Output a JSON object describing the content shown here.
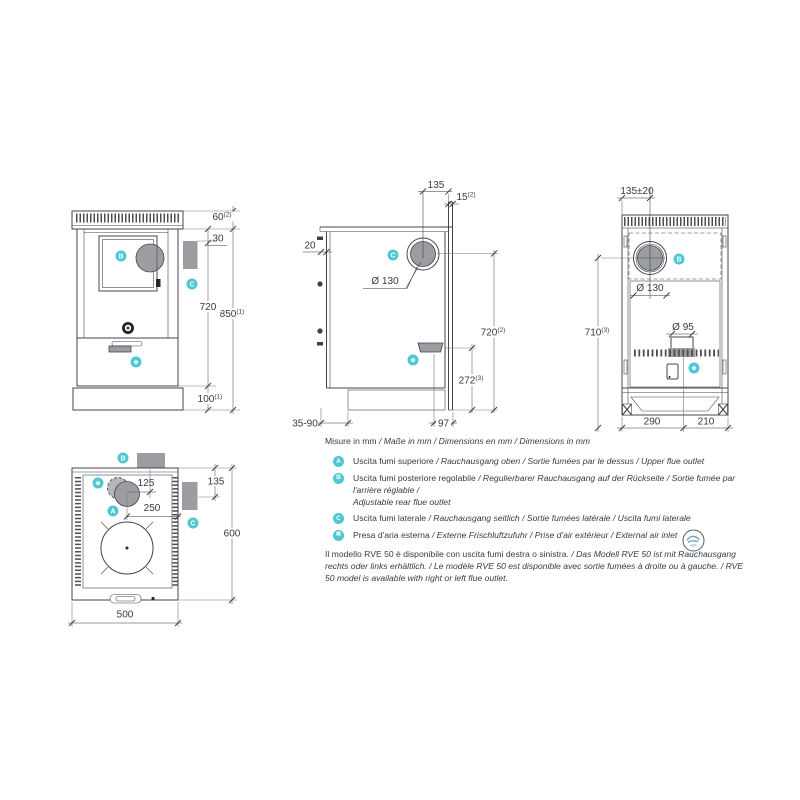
{
  "colors": {
    "teal": "#4ec7d0",
    "gray": "#9b9da0",
    "grayl": "#b3b5b8",
    "line": "#41464c",
    "dimline": "#75797d",
    "text": "#343b45",
    "badge_blue": "#6fa3c8"
  },
  "views": {
    "front": {
      "badges": {
        "b": "B",
        "c": "C",
        "star": "✱"
      },
      "dims": {
        "h60": {
          "v": "60",
          "s": "(2)"
        },
        "h30": {
          "v": "30"
        },
        "h720": {
          "v": "720"
        },
        "h850": {
          "v": "850",
          "s": "(1)"
        },
        "h100": {
          "v": "100",
          "s": "(1)"
        }
      }
    },
    "side": {
      "badges": {
        "c": "C",
        "star": "✱"
      },
      "dims": {
        "w135": {
          "v": "135"
        },
        "w15": {
          "v": "15",
          "s": "(2)"
        },
        "w20": {
          "v": "20"
        },
        "dia130": {
          "v": "Ø 130"
        },
        "h720": {
          "v": "720",
          "s": "(2)"
        },
        "h272": {
          "v": "272",
          "s": "(3)"
        },
        "w3590": {
          "v": "35-90"
        },
        "w97": {
          "v": "97"
        }
      }
    },
    "back": {
      "badges": {
        "b": "B",
        "star": "✱"
      },
      "dims": {
        "w135": {
          "v": "135±20"
        },
        "dia130": {
          "v": "Ø 130"
        },
        "dia95": {
          "v": "Ø 95"
        },
        "h710": {
          "v": "710",
          "s": "(3)"
        },
        "w290": {
          "v": "290"
        },
        "w210": {
          "v": "210"
        }
      }
    },
    "top": {
      "badges": {
        "a": "A",
        "b": "B",
        "c": "C",
        "star": "✱"
      },
      "dims": {
        "w125": {
          "v": "125"
        },
        "w135": {
          "v": "135"
        },
        "w250": {
          "v": "250"
        },
        "h600": {
          "v": "600"
        },
        "w500": {
          "v": "500"
        }
      }
    }
  },
  "legend": {
    "units_roman": "Misure in mm",
    "units_italic": " / Maße in mm / Dimensions en mm / Dimensions in mm",
    "items": [
      {
        "badge": "A",
        "roman": "Uscita fumi superiore",
        "italic": " / Rauchausgang oben  / Sortie fumées par le dessus / Upper flue outlet"
      },
      {
        "badge": "B",
        "roman": "Uscita fumi posteriore regolabile",
        "italic": " /  Regulierbarer Rauchausgang auf der Rückseite / Sortie fumée par l'arrière réglable /",
        "italic2": "Adjustable rear flue outlet"
      },
      {
        "badge": "C",
        "roman": "Uscita fumi laterale",
        "italic": " / Rauchausgang seitlich  / Sortie fumées latérale / Uscita fumi laterale"
      },
      {
        "badge": "✱",
        "roman": "Presa d'aria esterna",
        "italic": " / Externe Frischluftzufuhr / Prise d'air extérieur / External air inlet"
      }
    ],
    "air_badge_label": "AIR",
    "note_roman": "Il modello RVE 50 è disponibile con uscita fumi destra o sinistra.",
    "note_italic": " / Das Modell RVE 50 ist mit Rauchausgang rechts oder links erhältlich. / Le modèle RVE 50 est disponible avec sortie fumées à droite ou à gauche. / RVE 50 model is available with right or left flue outlet."
  }
}
